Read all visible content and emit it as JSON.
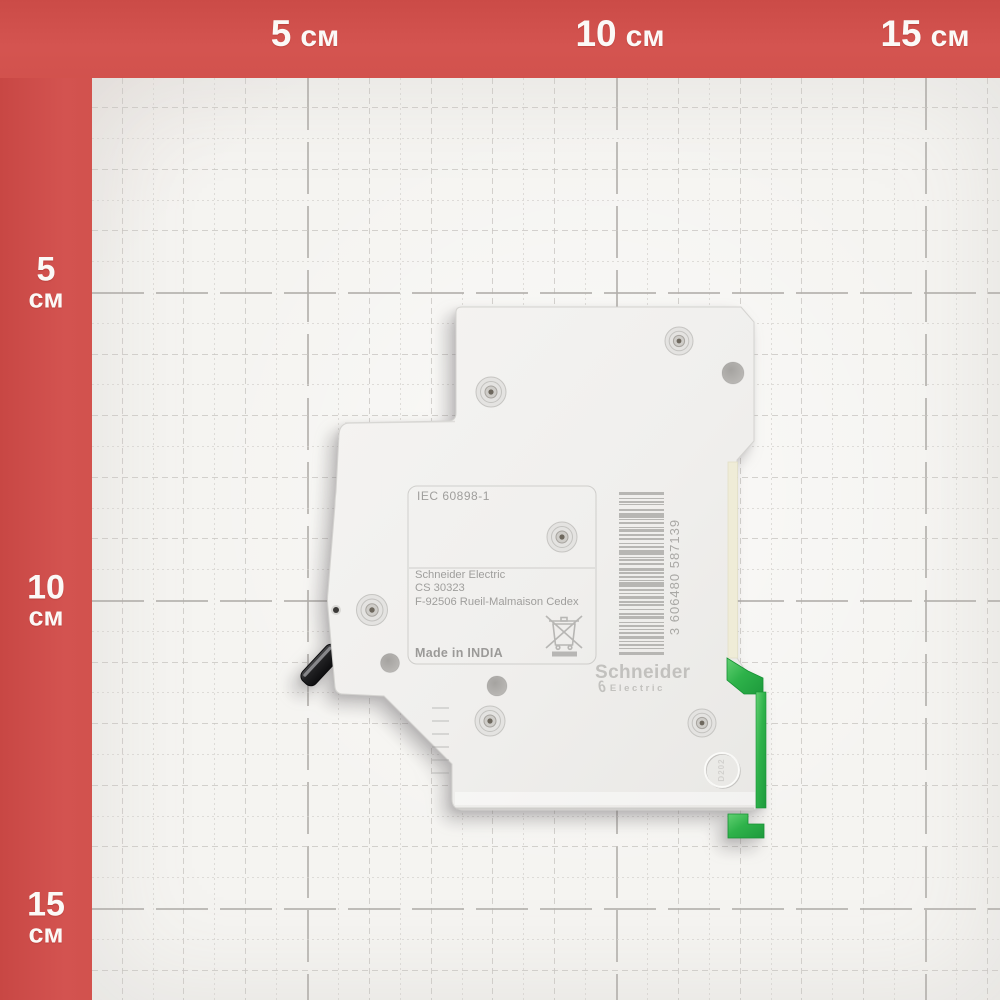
{
  "ruler": {
    "top": [
      {
        "value": "5",
        "unit": "см",
        "x": 305
      },
      {
        "value": "10",
        "unit": "см",
        "x": 620
      },
      {
        "value": "15",
        "unit": "см",
        "x": 925
      }
    ],
    "left": [
      {
        "value": "5",
        "unit": "см",
        "y": 283
      },
      {
        "value": "10",
        "unit": "см",
        "y": 601
      },
      {
        "value": "15",
        "unit": "см",
        "y": 918
      }
    ]
  },
  "breaker": {
    "standard": "IEC 60898-1",
    "address_line1": "Schneider Electric",
    "address_line2": "CS 30323",
    "address_line3": "F-92506 Rueil-Malmaison Cedex",
    "origin": "Made in INDIA",
    "brand": "Schneider",
    "brand_sub": "Electric",
    "brand_loop_glyph": "∂",
    "barcode_number": "3 606480 587139",
    "mold_stamp": "D202",
    "barcode_bars": [
      [
        3,
        2
      ],
      [
        1,
        2
      ],
      [
        2,
        1
      ],
      [
        1,
        3
      ],
      [
        2,
        2
      ],
      [
        4,
        1
      ],
      [
        1,
        2
      ],
      [
        2,
        2
      ],
      [
        1,
        1
      ],
      [
        3,
        2
      ],
      [
        1,
        2
      ],
      [
        2,
        3
      ],
      [
        1,
        1
      ],
      [
        2,
        2
      ],
      [
        4,
        2
      ],
      [
        1,
        1
      ],
      [
        2,
        2
      ],
      [
        1,
        3
      ],
      [
        3,
        1
      ],
      [
        1,
        2
      ],
      [
        2,
        2
      ],
      [
        1,
        1
      ],
      [
        4,
        2
      ],
      [
        2,
        1
      ],
      [
        1,
        2
      ],
      [
        3,
        2
      ],
      [
        1,
        1
      ],
      [
        2,
        3
      ],
      [
        1,
        2
      ],
      [
        2,
        1
      ],
      [
        3,
        2
      ],
      [
        1,
        2
      ],
      [
        2,
        2
      ],
      [
        1,
        1
      ],
      [
        2,
        2
      ],
      [
        3,
        1
      ],
      [
        1,
        2
      ],
      [
        2,
        2
      ],
      [
        1,
        2
      ],
      [
        3,
        2
      ]
    ]
  },
  "colors": {
    "ruler_red": "#d1504b",
    "paper": "#f5f4f1",
    "clip_green": "#2eb24a",
    "body_white": "#f3f2f0",
    "print_gray": "#9f9e9c",
    "barcode_gray": "#b7b6b3"
  }
}
